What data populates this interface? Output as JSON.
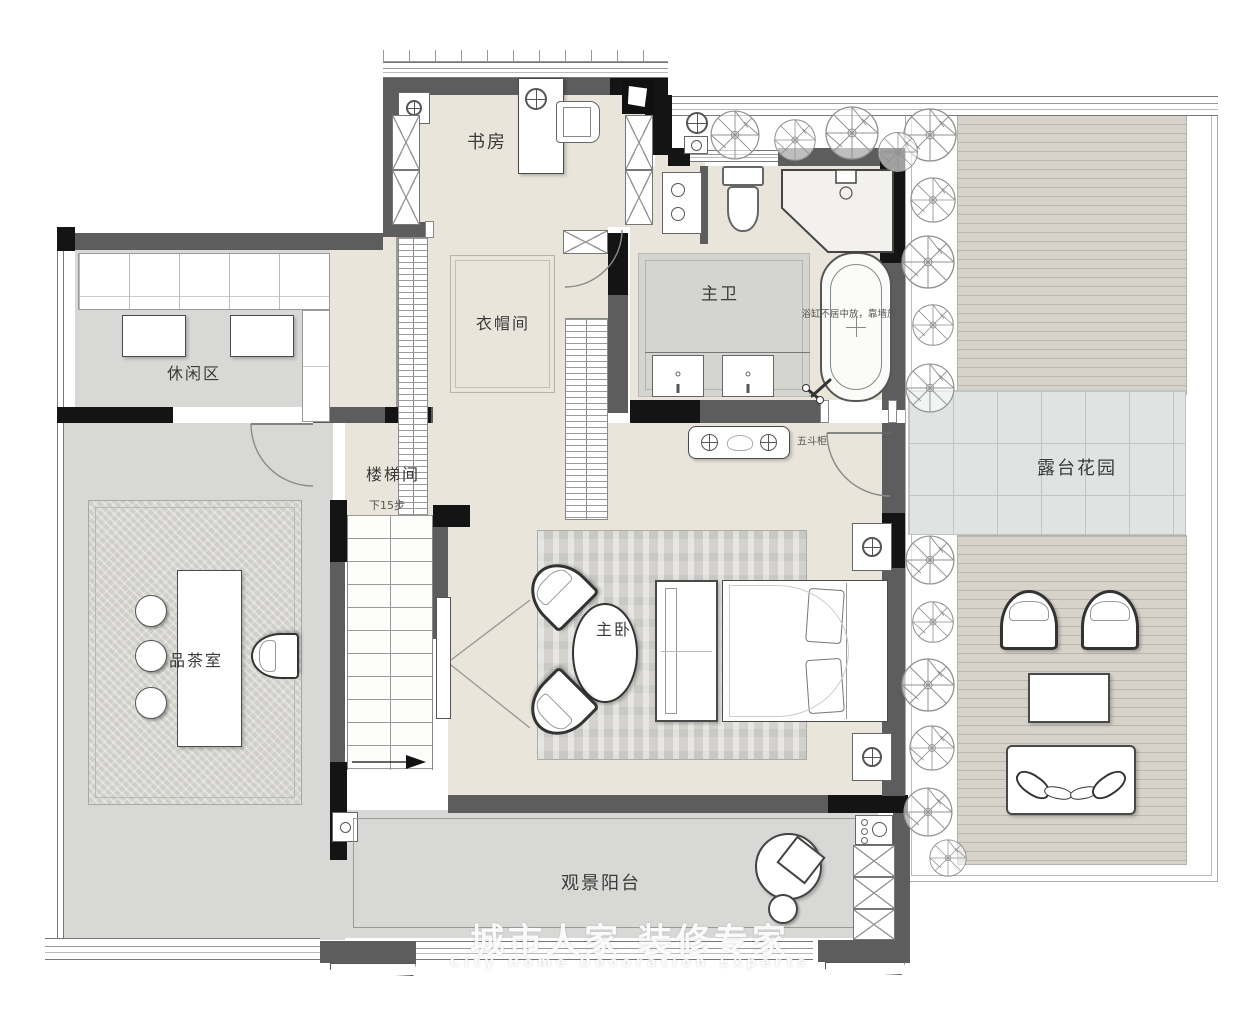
{
  "title": "二层平面布置图",
  "watermark": {
    "cn": "城市人家 装修专家",
    "en": "City Home Decoration Experts"
  },
  "rooms": {
    "study": {
      "label": "书房"
    },
    "closet": {
      "label": "衣帽间"
    },
    "master_bath": {
      "label": "主卫",
      "note": "浴缸不居中放，靠墙放"
    },
    "leisure": {
      "label": "休闲区"
    },
    "stairwell": {
      "label": "楼梯间",
      "steps_note": "下15步"
    },
    "tea_room": {
      "label": "品茶室"
    },
    "master_bedroom": {
      "label": "主卧",
      "dresser_label": "五斗柜"
    },
    "balcony": {
      "label": "观景阳台"
    },
    "terrace": {
      "label": "露台花园"
    }
  },
  "colors": {
    "wall_gray": "#5d5d5d",
    "wall_black": "#141414",
    "floor_cream": "#e9e5db",
    "floor_gray": "#d8d8d6",
    "rug": "#cfcec9",
    "deck": "#d7d2ca",
    "deck_line": "#bcb7ae",
    "paving": "#dfe3e2",
    "paving_line": "#bfc5c4",
    "mat": "#d4d4d1",
    "tree_stroke": "#909090"
  }
}
